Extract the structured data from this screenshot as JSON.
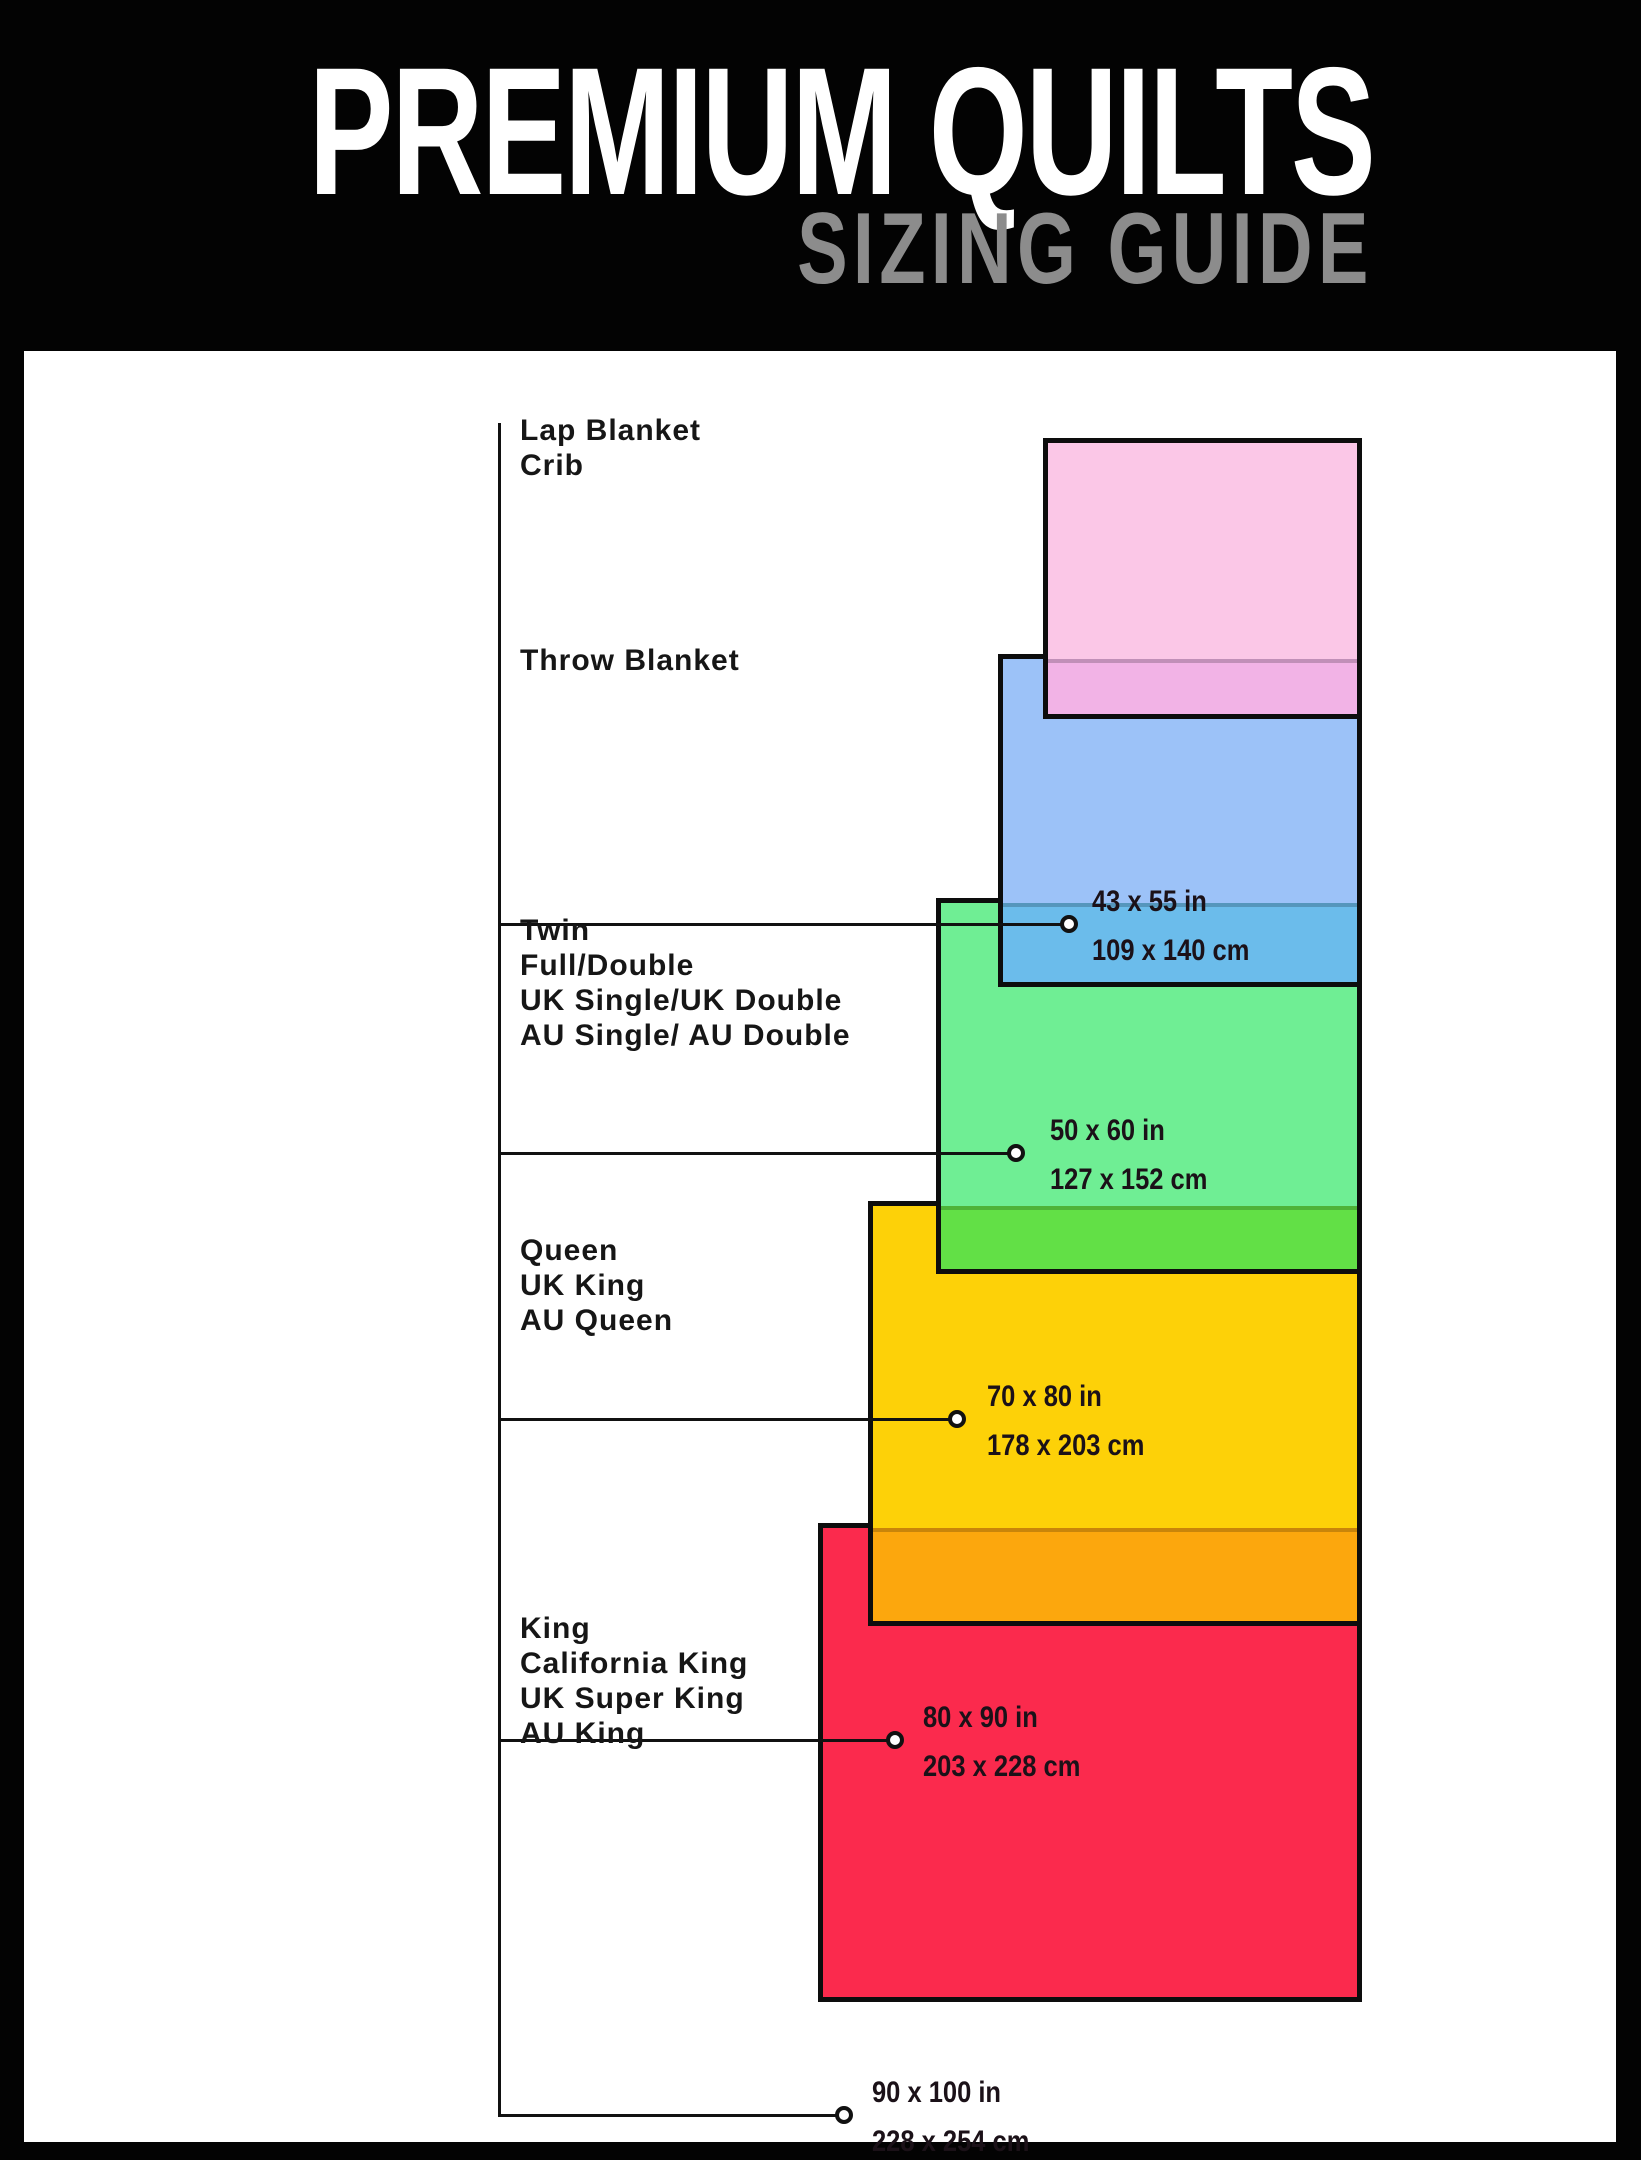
{
  "header": {
    "title": "PREMIUM QUILTS",
    "subtitle": "SIZING GUIDE"
  },
  "colors": {
    "background": "#030303",
    "panel": "#ffffff",
    "title": "#ffffff",
    "subtitle": "#8c8c8c",
    "label_text": "#161616",
    "leader_line": "#111111"
  },
  "sections": [
    {
      "labels": [
        "Lap Blanket",
        "Crib"
      ],
      "inches": "43 x 55 in",
      "cm": "109 x 140 cm",
      "fill": "#FBC7E7",
      "overlap_fill": "#F2B3E6"
    },
    {
      "labels": [
        "Throw Blanket"
      ],
      "inches": "50 x 60 in",
      "cm": "127 x 152 cm",
      "fill": "#9CC2F8",
      "overlap_fill": "#6BBCEB"
    },
    {
      "labels": [
        "Twin",
        "Full/Double",
        "UK Single/UK Double",
        "AU Single/ AU Double"
      ],
      "inches": "70 x 80 in",
      "cm": "178 x 203 cm",
      "fill": "#6FEE94",
      "overlap_fill": "#62E046"
    },
    {
      "labels": [
        "Queen",
        "UK King",
        "AU Queen"
      ],
      "inches": "80 x 90 in",
      "cm": "203 x 228 cm",
      "fill": "#FDD108",
      "overlap_fill": "#FCA70D"
    },
    {
      "labels": [
        "King",
        "California King",
        "UK Super King",
        "AU King"
      ],
      "inches": "90 x 100 in",
      "cm": "228 x 254 cm",
      "fill": "#FB2A4D",
      "overlap_fill": null
    }
  ]
}
